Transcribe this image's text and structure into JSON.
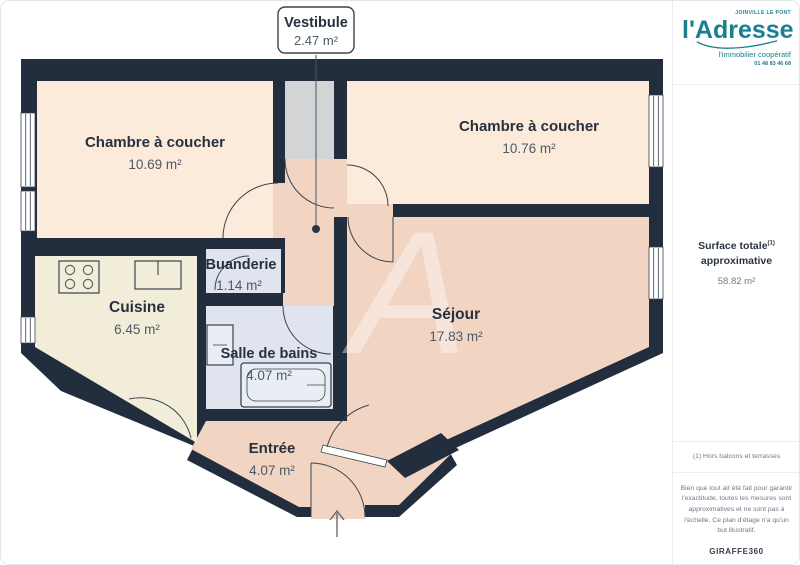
{
  "callout": {
    "title": "Vestibule",
    "area": "2.47 m²"
  },
  "rooms": [
    {
      "id": "chambre-a-coucher-1",
      "name": "Chambre à coucher",
      "area": "10.69 m²"
    },
    {
      "id": "chambre-a-coucher-2",
      "name": "Chambre à coucher",
      "area": "10.76 m²"
    },
    {
      "id": "sejour",
      "name": "Séjour",
      "area": "17.83 m²"
    },
    {
      "id": "cuisine",
      "name": "Cuisine",
      "area": "6.45 m²"
    },
    {
      "id": "buanderie",
      "name": "Buanderie",
      "area": "1.14 m²"
    },
    {
      "id": "salle-de-bains",
      "name": "Salle de bains",
      "area": "4.07 m²"
    },
    {
      "id": "entree",
      "name": "Entrée",
      "area": "4.07 m²"
    }
  ],
  "watermark": "A",
  "branding": {
    "location": "JOINVILLE LE PONT",
    "logo": "l'Adresse",
    "tagline": "l'immobilier coopératif",
    "phone": "01 48 83 46 68"
  },
  "sidebar": {
    "surface_title_line1": "Surface totale",
    "surface_sup": "(1)",
    "surface_title_line2": "approximative",
    "surface_value": "58.82 m²",
    "footnote": "(1) Hors balcons et terrasses",
    "disclaimer": [
      "Bien que tout ait été fait pour garantir",
      "l'exactitude, toutes les mesures sont",
      "approximatives et ne sont pas à",
      "l'échelle. Ce plan d'étage n'a qu'un",
      "but illustratif."
    ],
    "credit": "GIRAFFE360"
  },
  "colors": {
    "wall": "#222d3d",
    "bedroom": "#fcebdb",
    "living": "#f2d4c3",
    "kitchen": "#f2edd8",
    "wet_room": "#dfe4ee",
    "closet": "#d2d4d6",
    "brand_teal": "#1a808f"
  }
}
